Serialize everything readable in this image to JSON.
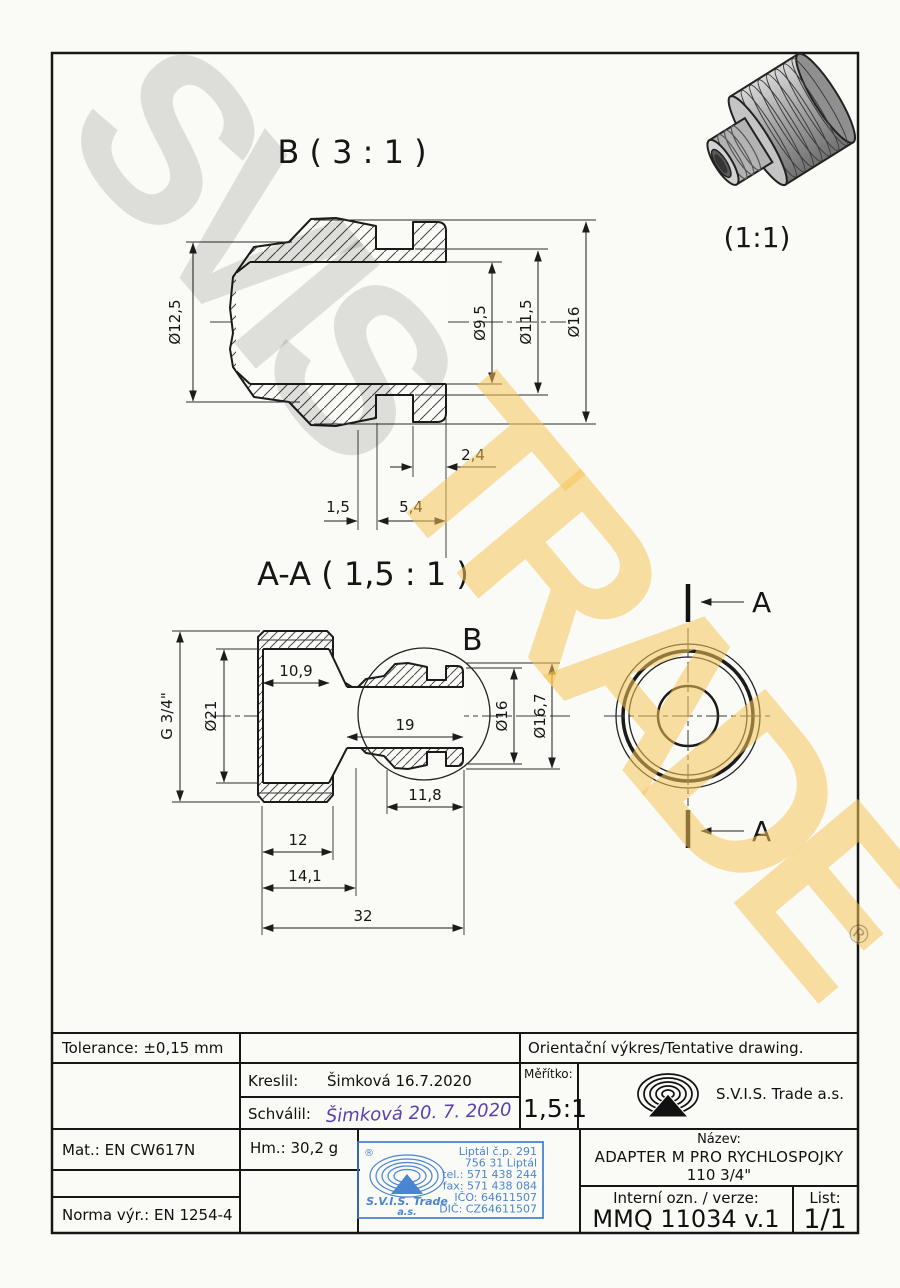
{
  "colors": {
    "paper": "#fbfbf7",
    "line": "#1b1b1b",
    "stamp_blue": "#3b7ccd",
    "signature_purple": "#5b3fae",
    "watermark_gray": "rgba(0,0,0,0.115)",
    "watermark_yellow": "rgba(246,197,90,0.55)"
  },
  "watermark": {
    "word1": "SVIS",
    "word2": "TRADE",
    "registered": "®"
  },
  "views": {
    "detail_b": {
      "title": "B ( 3 : 1 )",
      "dims": {
        "od_olive": "Ø12,5",
        "bore": "Ø9,5",
        "groove": "Ø11,5",
        "od": "Ø16",
        "d24": "2,4",
        "d15": "1,5",
        "d54": "5,4"
      }
    },
    "section_aa": {
      "title": "A-A ( 1,5 : 1 )",
      "detail_marker": "B",
      "dims": {
        "thread": "G 3/4\"",
        "d21": "Ø21",
        "d109": "10,9",
        "d19": "19",
        "d16": "Ø16",
        "d167": "Ø16,7",
        "d118": "11,8",
        "d12": "12",
        "d141": "14,1",
        "d32": "32"
      }
    },
    "end_view": {
      "cut_label_top": "A",
      "cut_label_bottom": "A"
    },
    "photo": {
      "scale_label": "(1:1)"
    }
  },
  "title_block": {
    "tolerance": "Tolerance: ±0,15 mm",
    "orientacni": "Orientační výkres/Tentative drawing.",
    "kreslil_label": "Kreslil:",
    "kreslil_value": "Šimková 16.7.2020",
    "schvalil_label": "Schválil:",
    "schvalil_signature": "Šimková 20. 7. 2020",
    "meritko_label": "Měřítko:",
    "meritko_value": "1,5:1",
    "company": "S.V.I.S. Trade a.s.",
    "mat": "Mat.: EN CW617N",
    "hm": "Hm.: 30,2 g",
    "norma": "Norma výr.: EN 1254-4",
    "nazev_label": "Název:",
    "nazev_line1": "ADAPTER M PRO RYCHLOSPOJKY",
    "nazev_line2": "110 3/4\"",
    "interni_label": "Interní ozn. / verze:",
    "interni_value": "MMQ 11034 v.1",
    "list_label": "List:",
    "list_value": "1/1"
  },
  "stamp": {
    "registered": "®",
    "company_line1": "S.V.I.S. Trade",
    "company_line2": "a.s.",
    "address": [
      "Liptál č.p. 291",
      "756 31 Liptál",
      "tel.: 571 438 244",
      "fax: 571 438 084",
      "IČO: 64611507",
      "DIČ: CZ64611507"
    ]
  }
}
